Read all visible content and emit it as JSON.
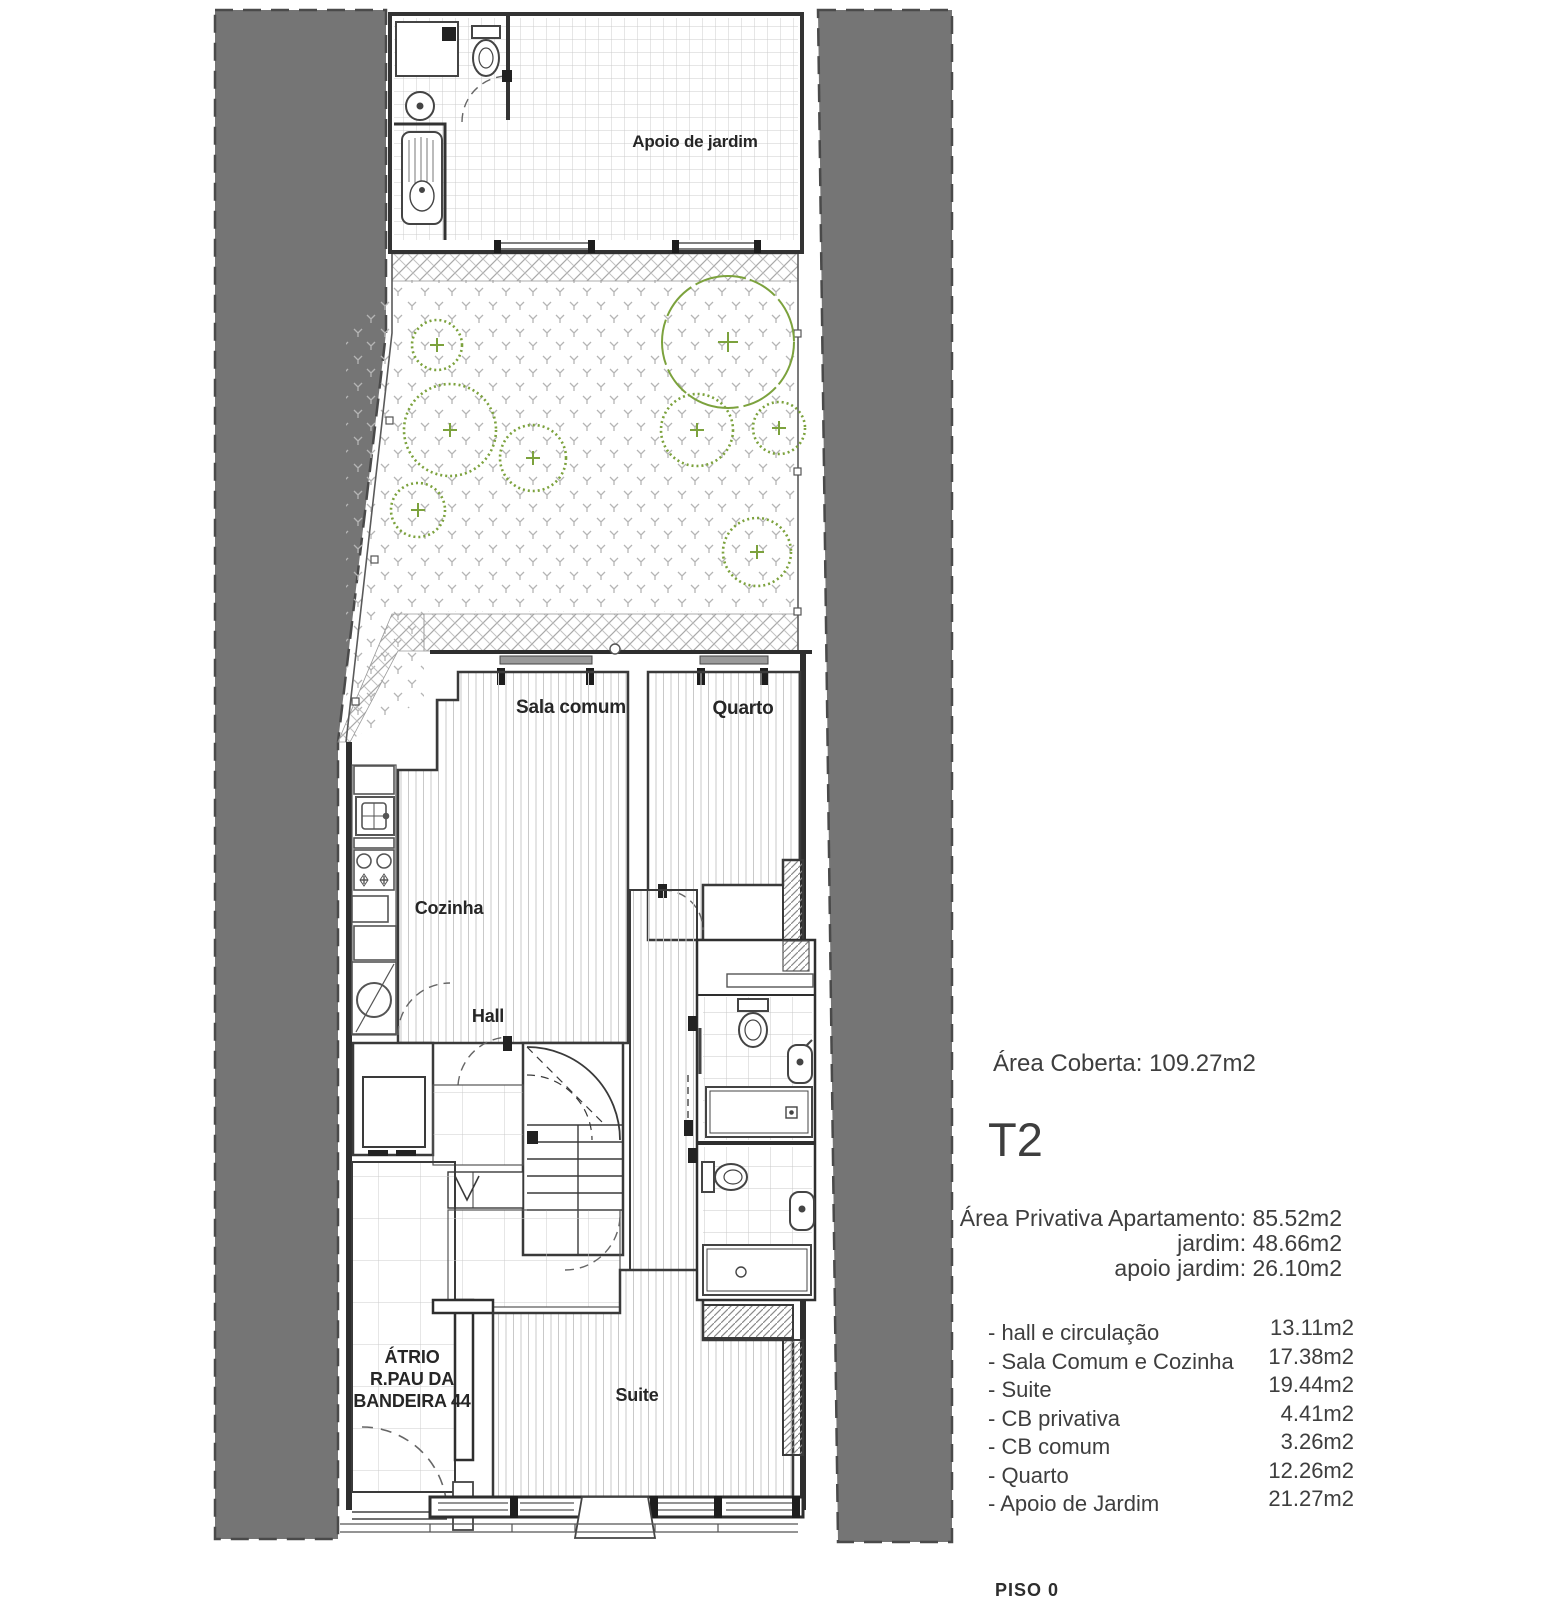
{
  "plan": {
    "labels": {
      "apoio_de_jardim": "Apoio de jardim",
      "sala_comum": "Sala comum",
      "quarto": "Quarto",
      "cozinha": "Cozinha",
      "hall": "Hall",
      "atrio": "ÁTRIO\nR.PAU DA\nBANDEIRA 44",
      "suite": "Suite"
    },
    "colors": {
      "neighbor_fill": "#757575",
      "wall_line": "#333333",
      "vegetation_green": "#7ca23d",
      "pattern_gray": "#bdbdbd"
    }
  },
  "info_panel": {
    "area_coberta": "Área Coberta: 109.27m2",
    "typology": "T2",
    "private_areas": [
      "Área Privativa Apartamento: 85.52m2",
      "jardim: 48.66m2",
      "apoio jardim:  26.10m2"
    ],
    "rooms": [
      {
        "name": "- hall e circulação",
        "area": "13.11m2"
      },
      {
        "name": "- Sala Comum e Cozinha",
        "area": "17.38m2"
      },
      {
        "name": "- Suite",
        "area": "19.44m2"
      },
      {
        "name": "- CB privativa",
        "area": "4.41m2"
      },
      {
        "name": "- CB comum",
        "area": "3.26m2"
      },
      {
        "name": "- Quarto",
        "area": "12.26m2"
      },
      {
        "name": "- Apoio de Jardim",
        "area": "21.27m2"
      }
    ],
    "floor_label": "PISO 0"
  }
}
